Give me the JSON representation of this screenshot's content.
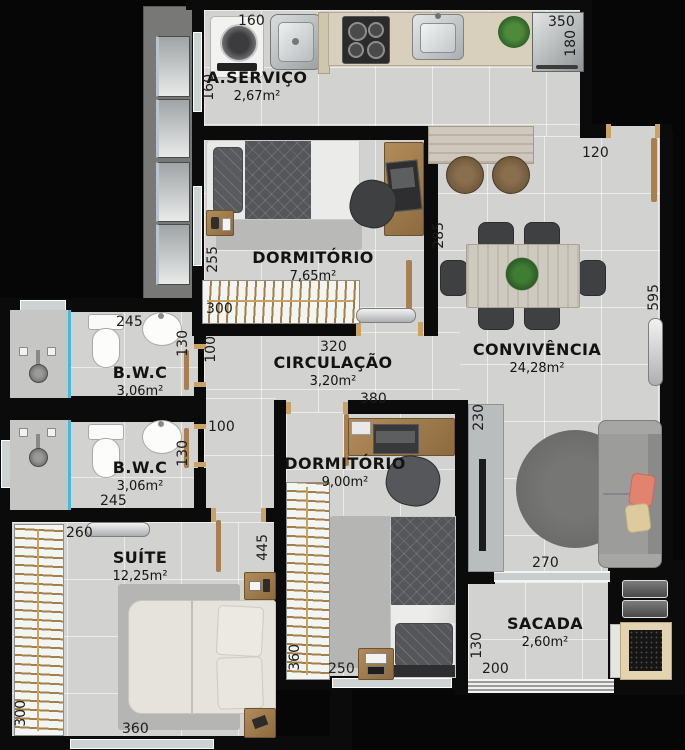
{
  "meta": {
    "type": "apartment floor plan",
    "units": "cm",
    "style": "top-down rendered plan"
  },
  "colors": {
    "wall": "#0b0b0b",
    "floor": "#d2d2d0",
    "shower_glass": "#49b8d8",
    "door_wood": "#a87f4f",
    "counter_beige": "#d8d0bd",
    "sofa_pillow_salmon": "#e2836f",
    "sofa_pillow_beige": "#ddcb9e"
  },
  "rooms": {
    "servico": {
      "name": "A.SERVIÇO",
      "area": "2,67m²",
      "furniture": [
        "washing-machine",
        "laundry-sink",
        "countertop",
        "cooktop",
        "kitchen-sink",
        "plant",
        "refrigerator"
      ]
    },
    "dorm1": {
      "name": "DORMITÓRIO",
      "area": "7,65m²",
      "furniture": [
        "single-bed",
        "nightstand",
        "rug",
        "desk",
        "laptop",
        "office-chair",
        "wardrobe",
        "air-conditioner"
      ]
    },
    "convivencia": {
      "name": "CONVIVÊNCIA",
      "area": "24,28m²",
      "furniture": [
        "bar-counter",
        "bar-stools",
        "dining-table",
        "six-chairs",
        "centerpiece-plant",
        "round-rug",
        "sofa",
        "tv-panel",
        "air-conditioner",
        "entry-door"
      ]
    },
    "circulacao": {
      "name": "CIRCULAÇÃO",
      "area": "3,20m²",
      "furniture": []
    },
    "bwc1": {
      "name": "B.W.C",
      "area": "3,06m²",
      "furniture": [
        "shower",
        "glass-partition",
        "toilet",
        "sink",
        "window"
      ]
    },
    "bwc2": {
      "name": "B.W.C",
      "area": "3,06m²",
      "furniture": [
        "shower",
        "glass-partition",
        "toilet",
        "sink"
      ]
    },
    "dorm2": {
      "name": "DORMITÓRIO",
      "area": "9,00m²",
      "furniture": [
        "desk",
        "laptop",
        "office-chair",
        "wardrobe",
        "single-bed",
        "nightstand",
        "rug",
        "window"
      ]
    },
    "suite": {
      "name": "SUÍTE",
      "area": "12,25m²",
      "furniture": [
        "wardrobe",
        "air-conditioner",
        "double-bed",
        "nightstands",
        "rug",
        "window"
      ]
    },
    "sacada": {
      "name": "SACADA",
      "area": "2,60m²",
      "furniture": [
        "barbecue-grill",
        "shelves",
        "railing",
        "sliding-door"
      ]
    }
  },
  "dims": {
    "laundry_w": "160",
    "laundry_h": "160",
    "fridge_w": "350",
    "fridge_d": "180",
    "entry_w": "120",
    "conviv_w": "285",
    "conviv_h": "595",
    "dorm1_h": "255",
    "dorm1_closet": "300",
    "circ_w": "320",
    "circ_door": "100",
    "hall_door": "100",
    "dorm2_w": "380",
    "bwc1_w": "245",
    "bwc1_d": "130",
    "bwc2_w": "245",
    "bwc2_d": "130",
    "suite_top": "260",
    "suite_h": "445",
    "suite_left": "300",
    "suite_w": "360",
    "tv_wall": "230",
    "sofa_wall": "270",
    "dorm2_closet": "360",
    "dorm2_bottom": "250",
    "sacada_d": "130",
    "sacada_w": "200"
  }
}
